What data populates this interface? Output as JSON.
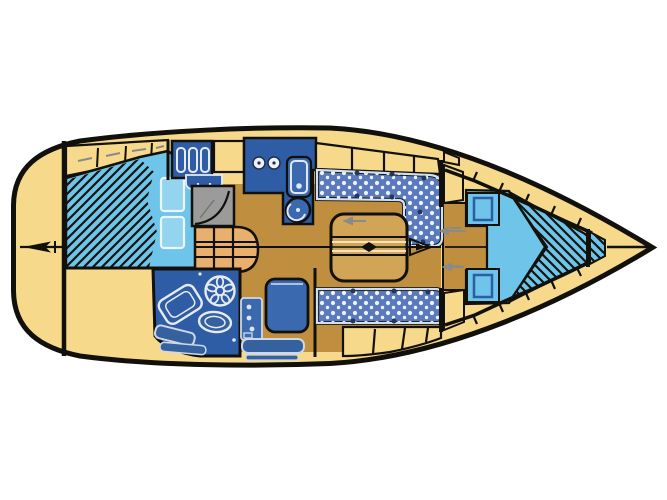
{
  "diagram": {
    "type": "sailboat-interior-floor-plan",
    "orientation": "bow-right, stern-left, top-down view",
    "colors": {
      "background": "#ffffff",
      "line": "#12100b",
      "deck": "#f6d98b",
      "berth": "#6ec5e9",
      "berth_light": "#93d4ef",
      "furniture": "#2e5ca5",
      "fixture": "#3a69b0",
      "fixture_dark": "#35619f",
      "upholstery": "#5b79bd",
      "trim": "#cfe0f2",
      "white_detail": "#e6ebf2",
      "floor": "#bf8f3f",
      "table": "#d2a456",
      "steps": "#e9af6d",
      "locker_gray": "#9b9b9b",
      "accent_gray": "#8a8a8a"
    },
    "regions": [
      "aft-deck",
      "rudder-marker",
      "aft-cabin-shelf",
      "aft-cabin-berth",
      "galley",
      "wet-locker",
      "companionway-steps",
      "head-compartment",
      "nav-station",
      "saloon-u-settee",
      "saloon-table",
      "starboard-settee",
      "mast-symbol",
      "forward-cabin-v-berth",
      "anchor-locker",
      "bow-tip"
    ]
  }
}
